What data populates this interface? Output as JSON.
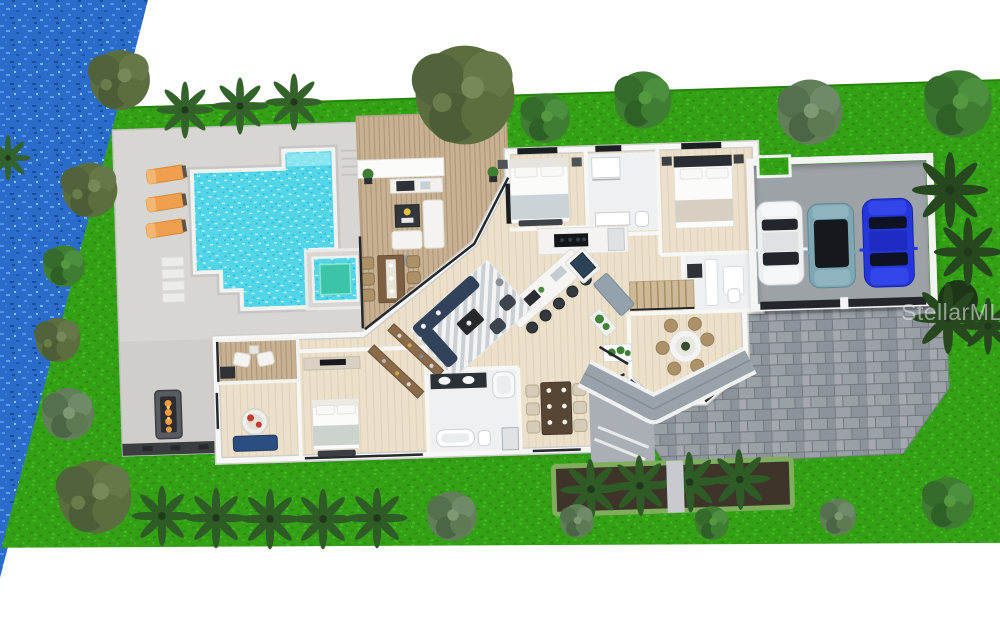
{
  "scene": {
    "description": "3D rendered aerial site plan of a waterfront single-family home",
    "watermark": "StellarMLS"
  },
  "site": {
    "waterfront": "canal water along left edge",
    "lawn": "green lawn band surrounding home",
    "pool_area": {
      "loungers": 3,
      "pool": "stepped freeform pool with tanning ledge",
      "spa": "square raised spa",
      "fire_pit": true,
      "deck_step_pads": 4
    },
    "outdoor_living": {
      "deck_dining_seats": 6,
      "outdoor_kitchen": true,
      "lounge_set": true,
      "covered_patio_chairs": 2
    },
    "house": {
      "bedrooms_visible": 3,
      "kitchen_island_stools": 5,
      "formal_dining_seats": 6,
      "breakfast_nook_seats": 6,
      "living_room": "navy sectional, two armchairs, chevron rug",
      "master_suite": "bed, blue bench, round chair, walk-in closet, double-vanity bath with two tubs",
      "stairs": true,
      "laundry_bath": true
    },
    "garage": {
      "bays": 3,
      "cars": [
        {
          "color": "white"
        },
        {
          "color": "teal"
        },
        {
          "color": "blue"
        }
      ]
    },
    "driveway": "gray paver driveway",
    "landscaping": {
      "bottom_palm_row": 5,
      "hedge_planter_palms": 4,
      "right_palm_cluster": 4,
      "top_trees": 5
    }
  },
  "colors": {
    "water_base": "#2b6ccb",
    "water_light": "#4f93ea",
    "grass_base": "#33a015",
    "grass_dark": "#2c8d0f",
    "grass_light": "#42b822",
    "pool_water": "#52d5e8",
    "pool_sparkle": "#b9f3fa",
    "spa_water": "#3cc4a9",
    "concrete": "#d7d6d3",
    "concrete_dark": "#c6c5c2",
    "seawall": "#3b3e40",
    "wood_deck": "#c7b192",
    "wood_gap": "#ad9474",
    "floor": "#ece0ca",
    "floor_gap": "#e0d2b8",
    "wall": "#f7f7f6",
    "tile": "#eef0f2",
    "roof": "#99a1a9",
    "porch": "#a9afb5",
    "paver": "#9ba1a7",
    "paver_joint": "#74797f",
    "garage_floor": "#9da2a7",
    "garage_door": "#23272b",
    "lounger": "#ef9f4e",
    "car_white": "#edeff1",
    "car_teal": "#7ea7b3",
    "car_teal_roof": "#15191e",
    "car_blue": "#2636dd",
    "sofa_navy": "#32425b",
    "island_white": "#f6f5f3",
    "stool_dark": "#33383e",
    "table_wood": "#7d6044",
    "chair_tan": "#ac9168",
    "soil": "#3f3429",
    "hedge": "#7fae5c",
    "tree_olive": "#5c6e3f",
    "tree_green": "#3f7d33",
    "tree_gray": "#637f59",
    "palm_green": "#33622a",
    "palm_dark": "#2f5c26",
    "palm_deep": "#27481f",
    "bench_blue": "#2c4d80",
    "fire_orange": "#f49b3c",
    "watermark": "rgba(236,239,241,0.55)"
  }
}
